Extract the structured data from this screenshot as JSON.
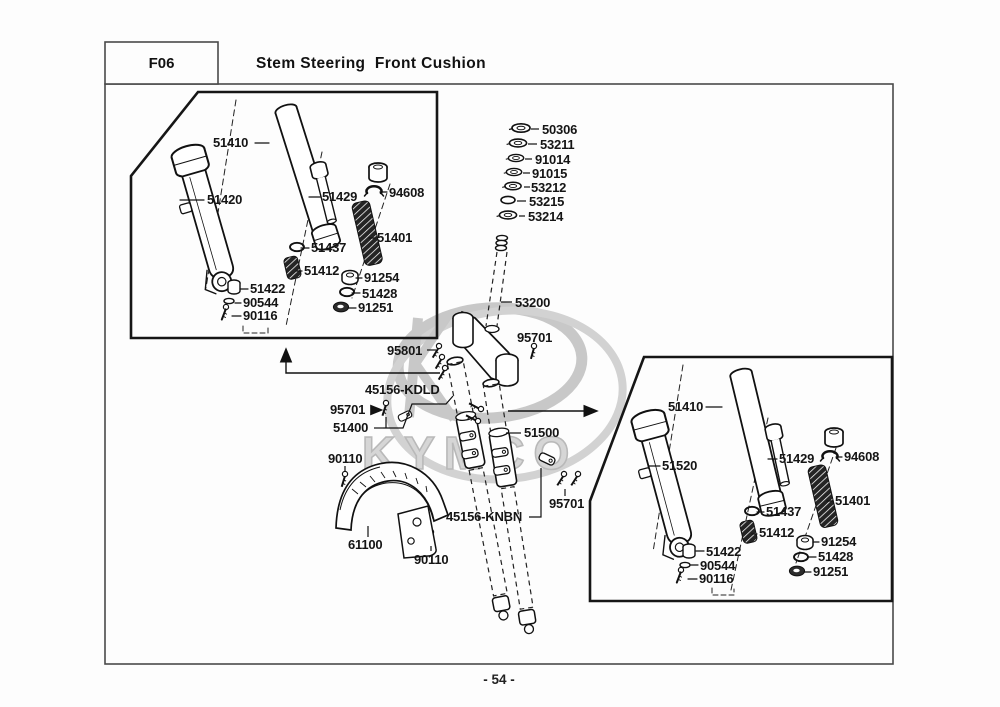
{
  "header": {
    "code": "F06",
    "title": "Stem Steering  Front Cushion"
  },
  "footer": {
    "page_number": "- 54 -"
  },
  "watermark": {
    "brand": "KYMCO",
    "color": "#c8c8c8"
  },
  "stack_labels": [
    "50306",
    "53211",
    "91014",
    "91015",
    "53212",
    "53215",
    "53214"
  ],
  "left_box_labels": [
    "51410",
    "51420",
    "51429",
    "94608",
    "51401",
    "51437",
    "51412",
    "51422",
    "90544",
    "90116",
    "91254",
    "51428",
    "91251"
  ],
  "right_box_labels": [
    "51410",
    "51520",
    "51429",
    "94608",
    "51401",
    "51437",
    "51412",
    "51422",
    "90544",
    "90116",
    "91254",
    "51428",
    "91251"
  ],
  "center_labels": {
    "steering_stem": "53200",
    "stem_bolt": "95701",
    "bridge_screws": "95801",
    "left_assembly_code": "45156-KDLD",
    "left_bolt": "95701",
    "left_cushion": "51400",
    "fender_screw_front": "90110",
    "fender": "61100",
    "fender_screw_rear": "90110",
    "right_assembly_code": "45156-KNBN",
    "right_cushion": "51500",
    "right_bolt": "95701"
  }
}
